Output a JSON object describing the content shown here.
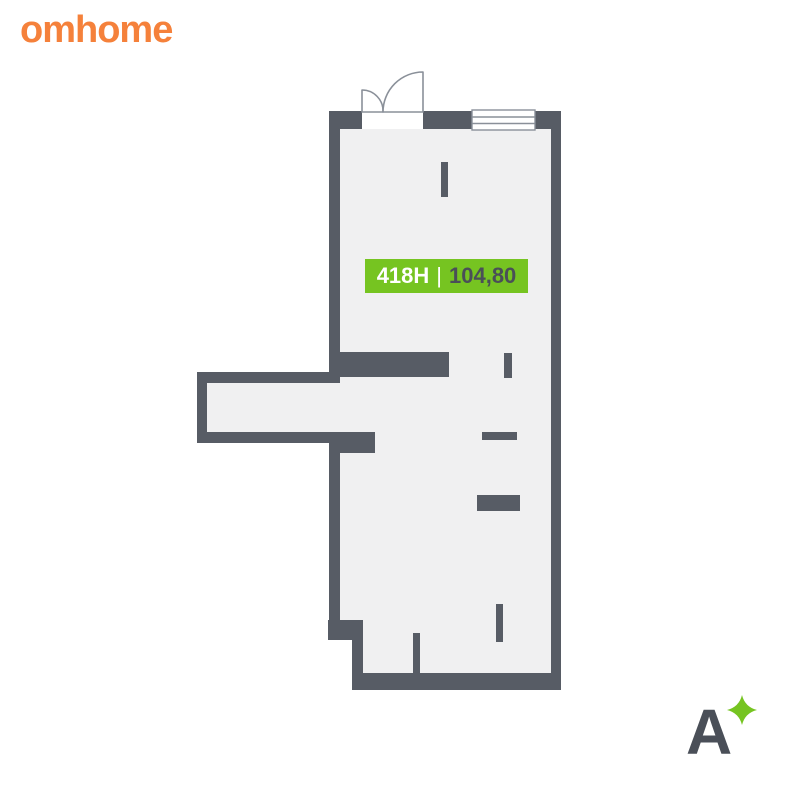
{
  "brand": {
    "logo_text": "omhome",
    "logo_color": "#F5813B"
  },
  "floorplan": {
    "unit_label": "418H",
    "separator": "|",
    "area_value": "104,80",
    "label_bg": "#76C421",
    "label_text_color": "#FFFFFF",
    "area_text_color": "#4A4F58",
    "wall_color": "#575C65",
    "floor_color": "#F0F0F1",
    "opening_stroke": "#8A9099",
    "window_fill": "#FFFFFF"
  },
  "watermark": {
    "letter": "A",
    "letter_color": "#4A4F58",
    "sparkle_color": "#76C421"
  }
}
